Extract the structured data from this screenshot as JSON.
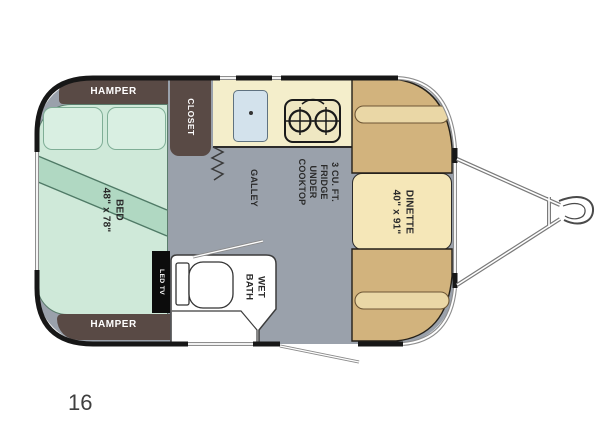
{
  "model_label": "16",
  "rooms": {
    "bed": {
      "lines": [
        "BED",
        "48\" x 78\""
      ]
    },
    "dinette": {
      "lines": [
        "DINETTE",
        "40\" x 91\""
      ]
    },
    "wet_bath": {
      "lines": [
        "WET",
        "BATH"
      ]
    },
    "galley": {
      "label": "GALLEY"
    },
    "fridge_note": {
      "lines": [
        "3 CU. FT.",
        "FRIDGE",
        "UNDER",
        "COOKTOP"
      ]
    },
    "closet": {
      "label": "CLOSET"
    },
    "hamper_front": {
      "label": "HAMPER"
    },
    "hamper_rear": {
      "label": "HAMPER"
    },
    "led_tv": {
      "label": "LED TV"
    }
  },
  "colors": {
    "floor_gray": "#9aa1ab",
    "bed_green": "#cfe9d9",
    "blanket_green": "#b0d8c2",
    "cabinet_brown": "#594a45",
    "counter_cream": "#f4eecb",
    "sink_blue": "#d3e2ec",
    "bench_tan": "#d2b37d",
    "table_tan": "#f5e7b8",
    "wall_black": "#171717",
    "bath_white": "#ffffff"
  }
}
